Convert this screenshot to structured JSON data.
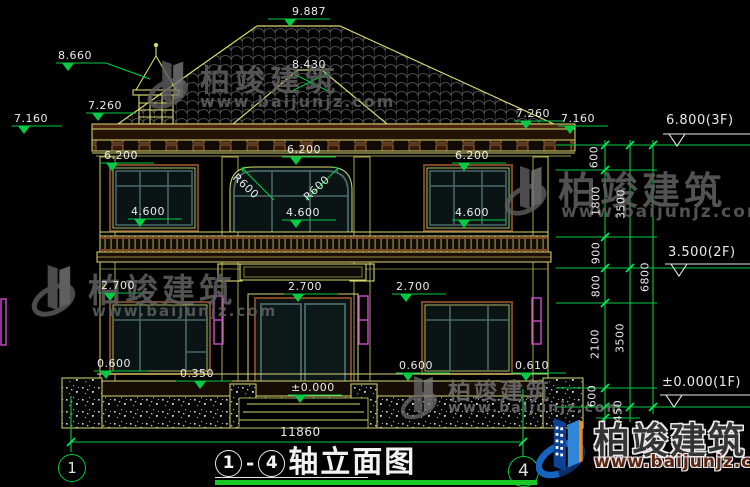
{
  "brand": {
    "name": "柏竣建筑",
    "url": "www.baijunjz.com"
  },
  "title": {
    "axis_start": "1",
    "dash": "-",
    "axis_end": "4",
    "text": "轴立面图"
  },
  "axes": {
    "left": "1",
    "right": "4"
  },
  "dims": {
    "apex": "9.887",
    "turret": "8.660",
    "ridge2": "8.430",
    "eave_left_inner": "7.260",
    "eave_left_outer": "7.160",
    "eave_right_inner": "7.260",
    "eave_right_outer": "7.160",
    "level_3f": "6.800(3F)",
    "level_2f": "3.500(2F)",
    "level_1f": "±0.000(1F)",
    "win2f_top_left": "6.200",
    "win2f_top_center": "6.200",
    "win2f_top_right": "6.200",
    "r600_left": "R600",
    "r600_right": "R600",
    "win2f_sill_left": "4.600",
    "win2f_sill_center": "4.600",
    "win2f_sill_right": "4.600",
    "head1f_left": "2.700",
    "head1f_center": "2.700",
    "head1f_right": "2.700",
    "sill1f_left": "0.600",
    "ledge_left": "0.350",
    "sill1f_right": "0.600",
    "ledge_right": "0.610",
    "door_zero": "±0.000",
    "total_width": "11860"
  },
  "vdims": {
    "c1": [
      "600",
      "1800",
      "900",
      "800",
      "2100",
      "600",
      "450"
    ],
    "c2": [
      "3500",
      "3500"
    ],
    "c3": [
      "6800"
    ]
  }
}
